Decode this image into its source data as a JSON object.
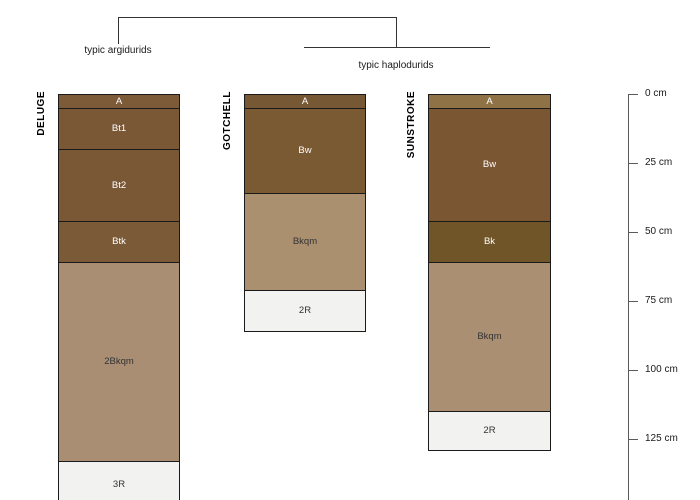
{
  "figure": {
    "background": "#ffffff",
    "border_color": "#1a1a1a",
    "axis_color": "#5a5a5a",
    "rock_color": "#f2f2f0"
  },
  "dendrogram": {
    "groups": [
      {
        "label": "typic argidurids",
        "members": [
          "DELUGE"
        ]
      },
      {
        "label": "typic haplodurids",
        "members": [
          "GOTCHELL",
          "SUNSTROKE"
        ]
      }
    ]
  },
  "depth_axis": {
    "unit": "cm",
    "ticks": [
      {
        "cm": 0,
        "label": "0 cm"
      },
      {
        "cm": 25,
        "label": "25 cm"
      },
      {
        "cm": 50,
        "label": "50 cm"
      },
      {
        "cm": 75,
        "label": "75 cm"
      },
      {
        "cm": 100,
        "label": "100 cm"
      },
      {
        "cm": 125,
        "label": "125 cm"
      }
    ]
  },
  "chart_data": {
    "type": "other",
    "subtype": "soil-profile-depth-sketch-with-dendrogram",
    "ylabel": "depth (cm)",
    "ylim": [
      0,
      147
    ],
    "profiles": [
      {
        "id": "DELUGE",
        "group": "typic argidurids",
        "horizons": [
          {
            "name": "A",
            "top_cm": 0,
            "bottom_cm": 5,
            "color": "#7D5A38",
            "label_color": "#FFFFFF"
          },
          {
            "name": "Bt1",
            "top_cm": 5,
            "bottom_cm": 20,
            "color": "#7A5836",
            "label_color": "#FFFFFF"
          },
          {
            "name": "Bt2",
            "top_cm": 20,
            "bottom_cm": 46,
            "color": "#7A5836",
            "label_color": "#FFFFFF"
          },
          {
            "name": "Btk",
            "top_cm": 46,
            "bottom_cm": 61,
            "color": "#7B5B37",
            "label_color": "#FFFFFF"
          },
          {
            "name": "2Bkqm",
            "top_cm": 61,
            "bottom_cm": 133,
            "color": "#A98E74",
            "label_color": "#333333"
          },
          {
            "name": "3R",
            "top_cm": 133,
            "bottom_cm": 150,
            "color": "#F2F2F0",
            "label_color": "#333333"
          }
        ]
      },
      {
        "id": "GOTCHELL",
        "group": "typic haplodurids",
        "horizons": [
          {
            "name": "A",
            "top_cm": 0,
            "bottom_cm": 5,
            "color": "#775834",
            "label_color": "#FFFFFF"
          },
          {
            "name": "Bw",
            "top_cm": 5,
            "bottom_cm": 36,
            "color": "#7A5A33",
            "label_color": "#FFFFFF"
          },
          {
            "name": "Bkqm",
            "top_cm": 36,
            "bottom_cm": 71,
            "color": "#AB9070",
            "label_color": "#333333"
          },
          {
            "name": "2R",
            "top_cm": 71,
            "bottom_cm": 86,
            "color": "#F2F2F0",
            "label_color": "#333333"
          }
        ]
      },
      {
        "id": "SUNSTROKE",
        "group": "typic haplodurids",
        "horizons": [
          {
            "name": "A",
            "top_cm": 0,
            "bottom_cm": 5,
            "color": "#8F7347",
            "label_color": "#FFFFFF"
          },
          {
            "name": "Bw",
            "top_cm": 5,
            "bottom_cm": 46,
            "color": "#7A5632",
            "label_color": "#FFFFFF"
          },
          {
            "name": "Bk",
            "top_cm": 46,
            "bottom_cm": 61,
            "color": "#6F5527",
            "label_color": "#FFFFFF"
          },
          {
            "name": "Bkqm",
            "top_cm": 61,
            "bottom_cm": 115,
            "color": "#AA8F72",
            "label_color": "#333333"
          },
          {
            "name": "2R",
            "top_cm": 115,
            "bottom_cm": 129,
            "color": "#F2F2F0",
            "label_color": "#333333"
          }
        ]
      }
    ]
  }
}
